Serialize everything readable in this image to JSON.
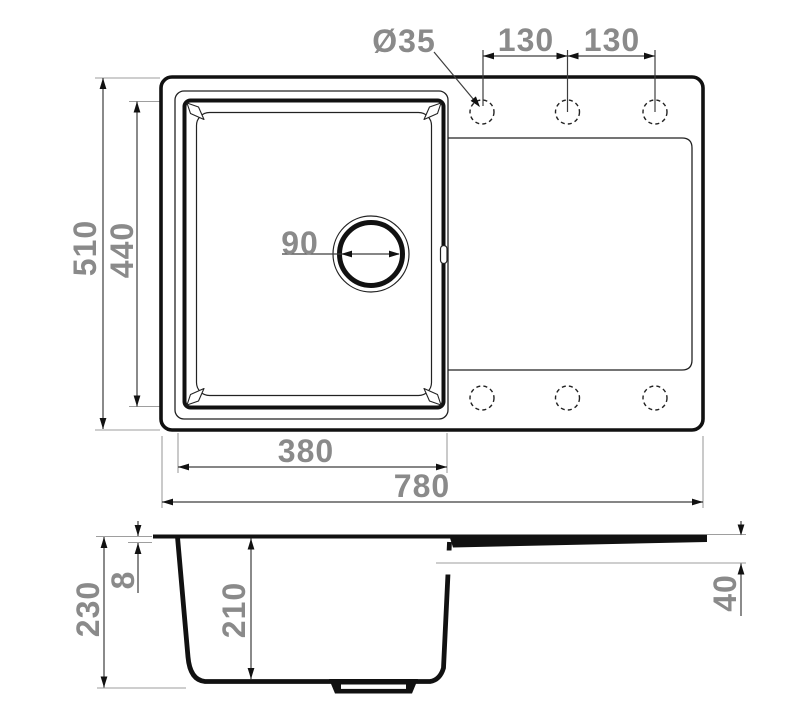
{
  "colors": {
    "profile_line": "#111111",
    "thin_line": "#222222",
    "dimension_line": "#3d3d3d",
    "extension_line": "#9e9e9e",
    "label": "#8a8a8a",
    "background": "#ffffff"
  },
  "top_view": {
    "dim_overall_width": "780",
    "dim_overall_depth": "510",
    "dim_bowl_width": "380",
    "dim_bowl_depth": "440",
    "dim_drain_diameter": "90",
    "dim_faucet_hole": "Ø35",
    "dim_hole_spacing_1": "130",
    "dim_hole_spacing_2": "130"
  },
  "section_view": {
    "dim_overall_height": "230",
    "dim_rim_thickness": "8",
    "dim_bowl_depth": "210",
    "dim_drainboard_height": "40"
  }
}
